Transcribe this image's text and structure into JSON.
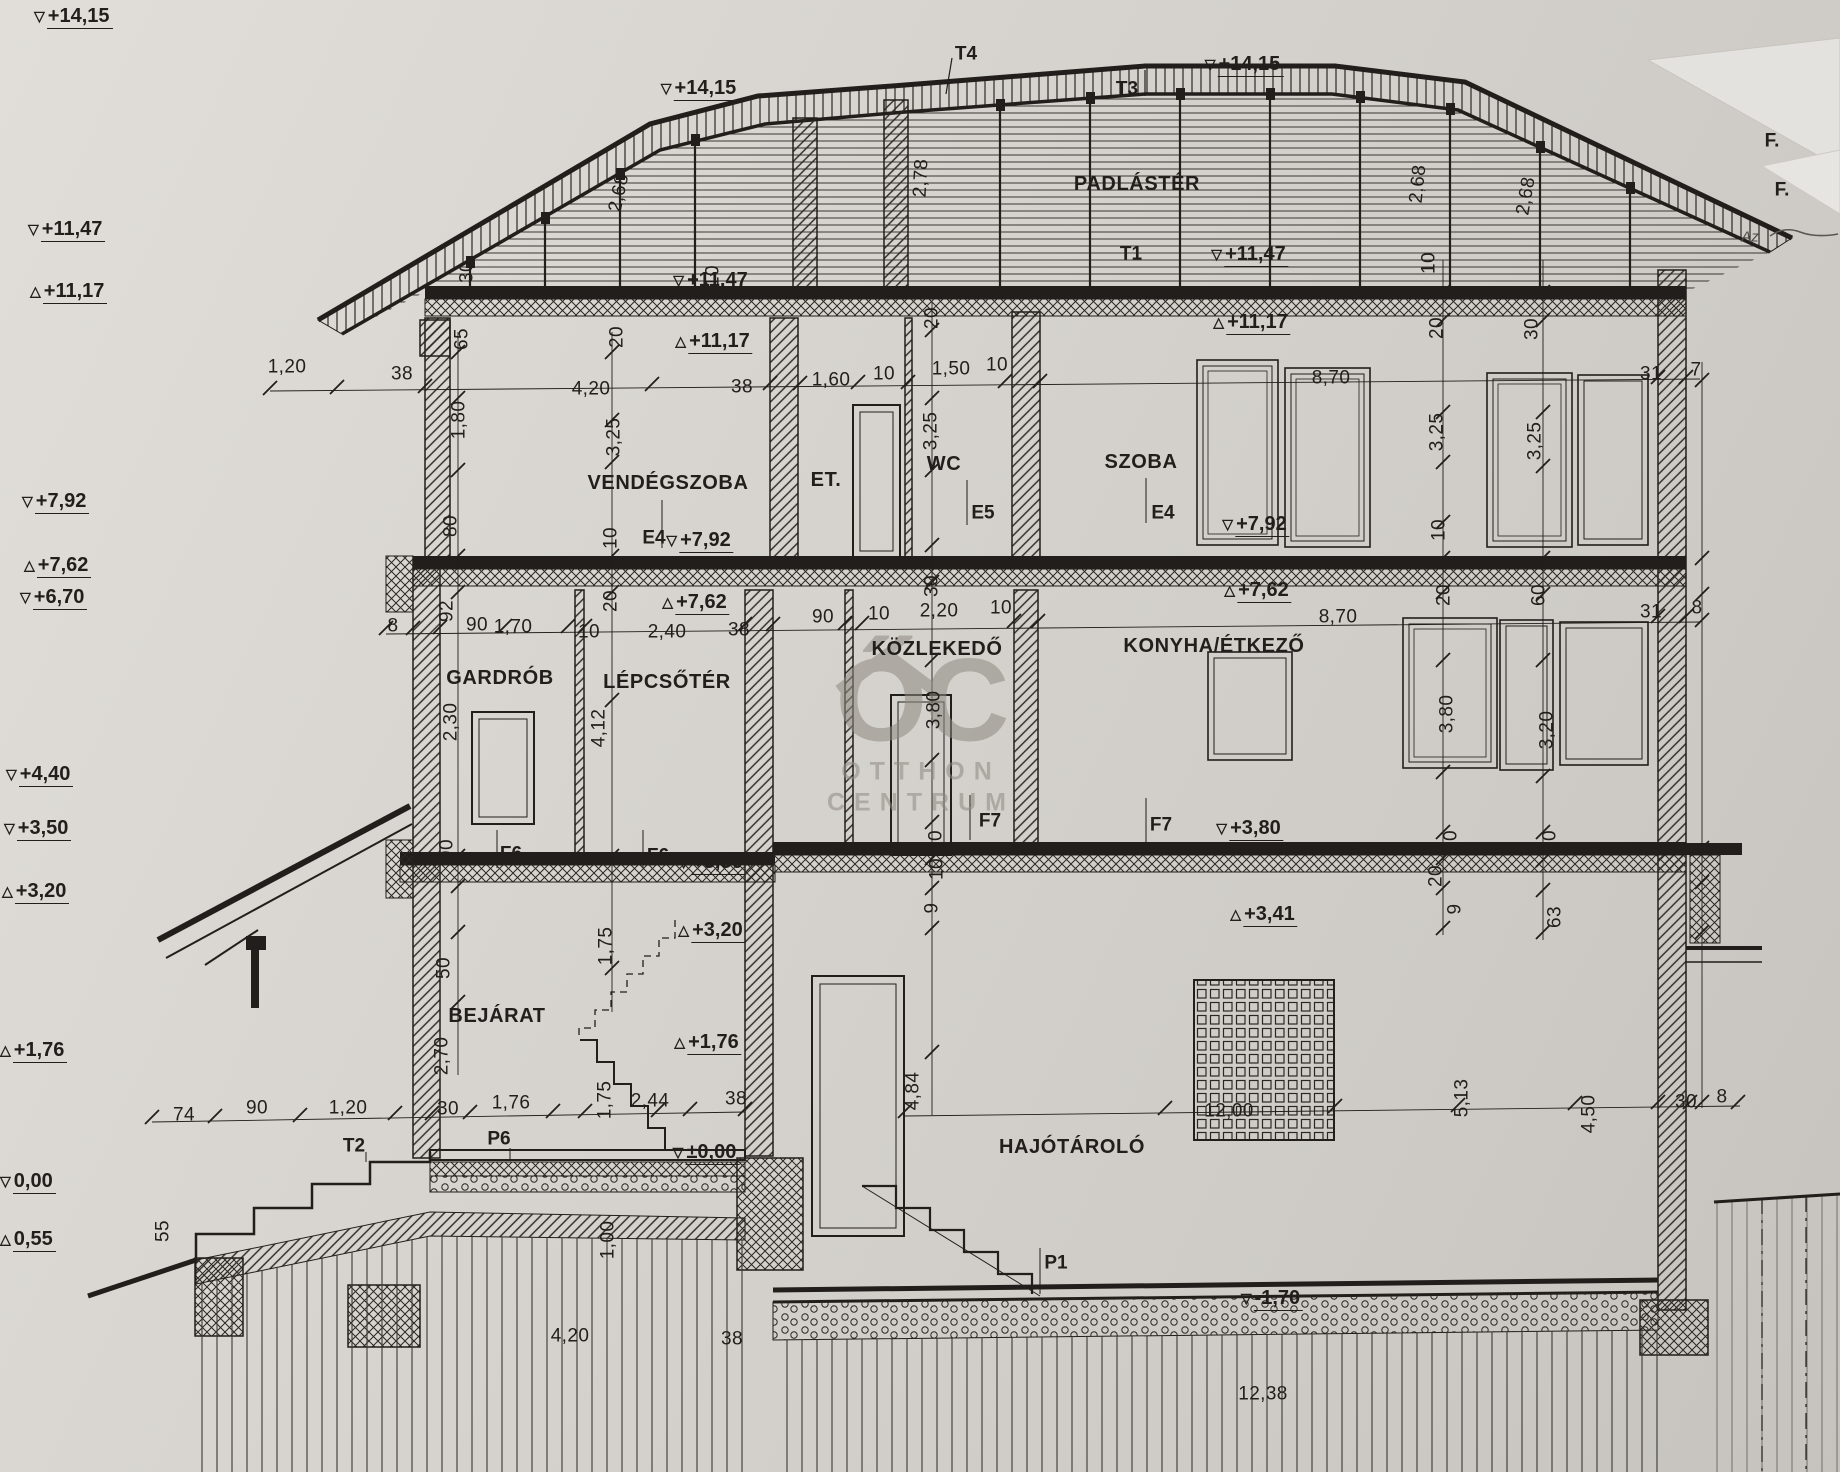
{
  "watermark": {
    "monogram": "ŐC",
    "line1": "OTTHON",
    "line2": "CENTRUM"
  },
  "labels": {
    "rooms": [
      {
        "t": "PADLÁSTÉR",
        "x": 1137,
        "y": 184
      },
      {
        "t": "VENDÉGSZOBA",
        "x": 668,
        "y": 483
      },
      {
        "t": "ET.",
        "x": 826,
        "y": 480
      },
      {
        "t": "WC",
        "x": 944,
        "y": 464
      },
      {
        "t": "SZOBA",
        "x": 1141,
        "y": 462
      },
      {
        "t": "GARDRÓB",
        "x": 500,
        "y": 678
      },
      {
        "t": "LÉPCSŐTÉR",
        "x": 667,
        "y": 682
      },
      {
        "t": "KÖZLEKEDŐ",
        "x": 937,
        "y": 649
      },
      {
        "t": "KONYHA/ÉTKEZŐ",
        "x": 1214,
        "y": 646
      },
      {
        "t": "BEJÁRAT",
        "x": 497,
        "y": 1016
      },
      {
        "t": "HAJÓTÁROLÓ",
        "x": 1072,
        "y": 1147
      }
    ],
    "refs": [
      {
        "t": "T4",
        "x": 966,
        "y": 54
      },
      {
        "t": "T3",
        "x": 1127,
        "y": 89
      },
      {
        "t": "T1",
        "x": 1131,
        "y": 254
      },
      {
        "t": "T2",
        "x": 354,
        "y": 1146
      },
      {
        "t": "P6",
        "x": 499,
        "y": 1139
      },
      {
        "t": "P1",
        "x": 1056,
        "y": 1263
      },
      {
        "t": "E4",
        "x": 654,
        "y": 538
      },
      {
        "t": "E5",
        "x": 983,
        "y": 513
      },
      {
        "t": "E4",
        "x": 1163,
        "y": 513
      },
      {
        "t": "F6",
        "x": 511,
        "y": 854
      },
      {
        "t": "F6",
        "x": 658,
        "y": 856
      },
      {
        "t": "F7",
        "x": 990,
        "y": 821
      },
      {
        "t": "F7",
        "x": 1161,
        "y": 825
      },
      {
        "t": "F.",
        "x": 1772,
        "y": 141
      },
      {
        "t": "F.",
        "x": 1782,
        "y": 190
      }
    ],
    "notes": [
      {
        "t": "Az",
        "x": 1750,
        "y": 237
      }
    ],
    "dims": [
      {
        "t": "30",
        "x": 467,
        "y": 272,
        "r": -90
      },
      {
        "t": "2,68",
        "x": 619,
        "y": 193,
        "r": -78
      },
      {
        "t": "10",
        "x": 713,
        "y": 276,
        "r": -90
      },
      {
        "t": "2,78",
        "x": 921,
        "y": 178,
        "r": -87
      },
      {
        "t": "20",
        "x": 932,
        "y": 318,
        "r": -90
      },
      {
        "t": "2,68",
        "x": 1418,
        "y": 184,
        "r": -84
      },
      {
        "t": "2,68",
        "x": 1526,
        "y": 196,
        "r": -80
      },
      {
        "t": "10",
        "x": 1429,
        "y": 263,
        "r": -90
      },
      {
        "t": "20",
        "x": 1437,
        "y": 328,
        "r": -90
      },
      {
        "t": "30",
        "x": 1532,
        "y": 329,
        "r": -90
      },
      {
        "t": "65",
        "x": 462,
        "y": 339,
        "r": -90
      },
      {
        "t": "20",
        "x": 617,
        "y": 337,
        "r": -90
      },
      {
        "t": "1,20",
        "x": 287,
        "y": 367
      },
      {
        "t": "38",
        "x": 402,
        "y": 374
      },
      {
        "t": "4,20",
        "x": 591,
        "y": 389
      },
      {
        "t": "38",
        "x": 742,
        "y": 387
      },
      {
        "t": "1,60",
        "x": 831,
        "y": 380
      },
      {
        "t": "10",
        "x": 884,
        "y": 374
      },
      {
        "t": "1,50",
        "x": 951,
        "y": 369
      },
      {
        "t": "10",
        "x": 997,
        "y": 365
      },
      {
        "t": "8,70",
        "x": 1331,
        "y": 378
      },
      {
        "t": "31",
        "x": 1651,
        "y": 374
      },
      {
        "t": "7",
        "x": 1696,
        "y": 370
      },
      {
        "t": "1,80",
        "x": 459,
        "y": 420,
        "r": -90
      },
      {
        "t": "3,25",
        "x": 614,
        "y": 437,
        "r": -90
      },
      {
        "t": "3,25",
        "x": 931,
        "y": 431,
        "r": -90
      },
      {
        "t": "3,25",
        "x": 1437,
        "y": 432,
        "r": -90
      },
      {
        "t": "3,25",
        "x": 1535,
        "y": 441,
        "r": -90
      },
      {
        "t": "80",
        "x": 451,
        "y": 526,
        "r": -90
      },
      {
        "t": "10",
        "x": 611,
        "y": 538,
        "r": -90
      },
      {
        "t": "10",
        "x": 1439,
        "y": 530,
        "r": -90
      },
      {
        "t": "20",
        "x": 611,
        "y": 601,
        "r": -90
      },
      {
        "t": "30",
        "x": 932,
        "y": 586,
        "r": -90
      },
      {
        "t": "20",
        "x": 1444,
        "y": 595,
        "r": -90
      },
      {
        "t": "60",
        "x": 1539,
        "y": 595,
        "r": -90
      },
      {
        "t": "8",
        "x": 393,
        "y": 626
      },
      {
        "t": "92",
        "x": 447,
        "y": 611,
        "r": -90
      },
      {
        "t": "90",
        "x": 477,
        "y": 625
      },
      {
        "t": "1,70",
        "x": 513,
        "y": 627
      },
      {
        "t": "10",
        "x": 589,
        "y": 632
      },
      {
        "t": "2,40",
        "x": 667,
        "y": 632
      },
      {
        "t": "38",
        "x": 739,
        "y": 630
      },
      {
        "t": "90",
        "x": 823,
        "y": 617
      },
      {
        "t": "10",
        "x": 879,
        "y": 614
      },
      {
        "t": "2,20",
        "x": 939,
        "y": 611
      },
      {
        "t": "10",
        "x": 1001,
        "y": 608
      },
      {
        "t": "8,70",
        "x": 1338,
        "y": 617
      },
      {
        "t": "31",
        "x": 1651,
        "y": 612
      },
      {
        "t": "8",
        "x": 1697,
        "y": 608
      },
      {
        "t": "2,30",
        "x": 451,
        "y": 722,
        "r": -90
      },
      {
        "t": "4,12",
        "x": 599,
        "y": 728,
        "r": -90
      },
      {
        "t": "3,80",
        "x": 934,
        "y": 710,
        "r": -90
      },
      {
        "t": "3,80",
        "x": 1447,
        "y": 714,
        "r": -90
      },
      {
        "t": "3,20",
        "x": 1547,
        "y": 730,
        "r": -90
      },
      {
        "t": "20",
        "x": 936,
        "y": 841,
        "r": -90
      },
      {
        "t": "10",
        "x": 937,
        "y": 869,
        "r": -90
      },
      {
        "t": "9",
        "x": 932,
        "y": 908,
        "r": -90
      },
      {
        "t": "10",
        "x": 1451,
        "y": 841,
        "r": -90
      },
      {
        "t": "30",
        "x": 1550,
        "y": 841,
        "r": -90
      },
      {
        "t": "20",
        "x": 1436,
        "y": 876,
        "r": -90
      },
      {
        "t": "9",
        "x": 1455,
        "y": 909,
        "r": -90
      },
      {
        "t": "63",
        "x": 1555,
        "y": 917,
        "r": -90
      },
      {
        "t": "90",
        "x": 447,
        "y": 850,
        "r": -90
      },
      {
        "t": "50",
        "x": 444,
        "y": 968,
        "r": -90
      },
      {
        "t": "1,75",
        "x": 606,
        "y": 946,
        "r": -90
      },
      {
        "t": "2,70",
        "x": 442,
        "y": 1056,
        "r": -90
      },
      {
        "t": "4,84",
        "x": 913,
        "y": 1091,
        "r": -90
      },
      {
        "t": "5,13",
        "x": 1462,
        "y": 1098,
        "r": -90
      },
      {
        "t": "4,50",
        "x": 1589,
        "y": 1114,
        "r": -90
      },
      {
        "t": "30",
        "x": 1686,
        "y": 1102
      },
      {
        "t": "8",
        "x": 1722,
        "y": 1097
      },
      {
        "t": "74",
        "x": 184,
        "y": 1115
      },
      {
        "t": "90",
        "x": 257,
        "y": 1108
      },
      {
        "t": "1,20",
        "x": 348,
        "y": 1108
      },
      {
        "t": "30",
        "x": 448,
        "y": 1109
      },
      {
        "t": "1,76",
        "x": 511,
        "y": 1103
      },
      {
        "t": "1,75",
        "x": 605,
        "y": 1100,
        "r": -90
      },
      {
        "t": "2,44",
        "x": 650,
        "y": 1101
      },
      {
        "t": "38",
        "x": 736,
        "y": 1099
      },
      {
        "t": "55",
        "x": 163,
        "y": 1231,
        "r": -90
      },
      {
        "t": "1,00",
        "x": 608,
        "y": 1240,
        "r": -90
      },
      {
        "t": "4,20",
        "x": 570,
        "y": 1336
      },
      {
        "t": "38",
        "x": 732,
        "y": 1339
      },
      {
        "t": "12,00",
        "x": 1229,
        "y": 1111
      },
      {
        "t": "12,38",
        "x": 1263,
        "y": 1394
      }
    ]
  },
  "levels": {
    "margin": [
      {
        "t": "+14,15",
        "x": 34,
        "y": 16,
        "d": "d"
      },
      {
        "t": "+11,47",
        "x": 28,
        "y": 229,
        "d": "d"
      },
      {
        "t": "+11,17",
        "x": 30,
        "y": 291,
        "d": "u"
      },
      {
        "t": "+7,92",
        "x": 22,
        "y": 501,
        "d": "d"
      },
      {
        "t": "+7,62",
        "x": 24,
        "y": 565,
        "d": "u"
      },
      {
        "t": "+6,70",
        "x": 20,
        "y": 597,
        "d": "d"
      },
      {
        "t": "+4,40",
        "x": 6,
        "y": 774,
        "d": "d"
      },
      {
        "t": "+3,50",
        "x": 4,
        "y": 828,
        "d": "d"
      },
      {
        "t": "+3,20",
        "x": 2,
        "y": 891,
        "d": "u"
      },
      {
        "t": "+1,76",
        "x": 0,
        "y": 1050,
        "d": "u"
      },
      {
        "t": "0,00",
        "x": 0,
        "y": 1181,
        "d": "d"
      },
      {
        "t": "0,55",
        "x": 0,
        "y": 1239,
        "d": "u"
      }
    ],
    "drawing": [
      {
        "t": "+14,15",
        "x": 700,
        "y": 88,
        "d": "d"
      },
      {
        "t": "+14,15",
        "x": 1244,
        "y": 64,
        "d": "d"
      },
      {
        "t": "+11,47",
        "x": 712,
        "y": 280,
        "d": "d"
      },
      {
        "t": "+11,17",
        "x": 714,
        "y": 341,
        "d": "u"
      },
      {
        "t": "+11,47",
        "x": 1250,
        "y": 254,
        "d": "d"
      },
      {
        "t": "+11,17",
        "x": 1252,
        "y": 322,
        "d": "u"
      },
      {
        "t": "+7,92",
        "x": 700,
        "y": 540,
        "d": "d"
      },
      {
        "t": "+7,62",
        "x": 696,
        "y": 602,
        "d": "u"
      },
      {
        "t": "+7,92",
        "x": 1256,
        "y": 524,
        "d": "d"
      },
      {
        "t": "+7,62",
        "x": 1258,
        "y": 590,
        "d": "u"
      },
      {
        "t": "+3,50",
        "x": 712,
        "y": 862,
        "d": "d"
      },
      {
        "t": "+3,20",
        "x": 712,
        "y": 930,
        "d": "u"
      },
      {
        "t": "+1,76",
        "x": 708,
        "y": 1042,
        "d": "u"
      },
      {
        "t": "+3,80",
        "x": 1250,
        "y": 828,
        "d": "d"
      },
      {
        "t": "+3,41",
        "x": 1264,
        "y": 914,
        "d": "u"
      },
      {
        "t": "±0,00",
        "x": 706,
        "y": 1152,
        "d": "d"
      },
      {
        "t": "-1,70",
        "x": 1272,
        "y": 1298,
        "d": "d"
      }
    ]
  }
}
